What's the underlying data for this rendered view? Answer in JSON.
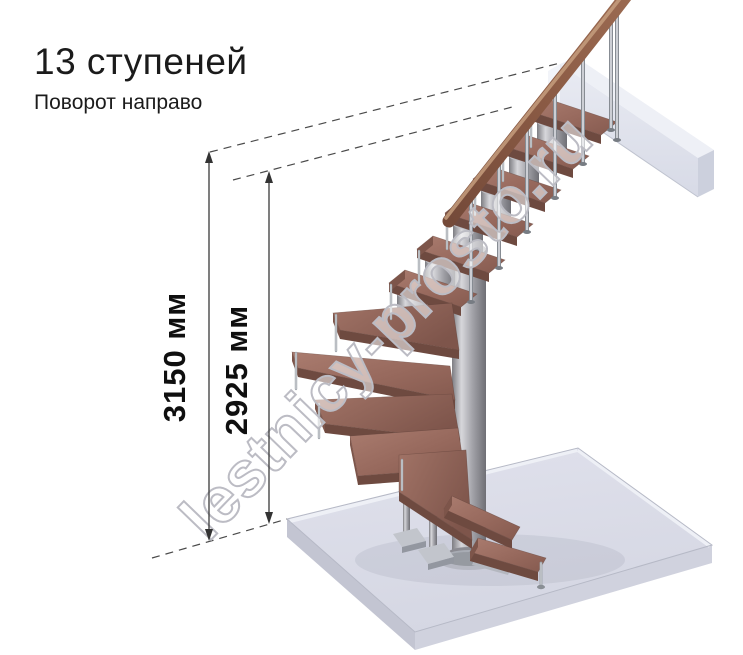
{
  "title": "13 ступеней",
  "subtitle": "Поворот направо",
  "staircase": {
    "steps_count": 13,
    "turn_direction": "направо",
    "type": "модульная лестница с поворотом 90°"
  },
  "dimensions": [
    {
      "id": "total-height",
      "label": "3150 мм",
      "value_mm": 3150
    },
    {
      "id": "height-to-top-step",
      "label": "2925 мм",
      "value_mm": 2925
    }
  ],
  "watermark": {
    "text": "lestnicy-prosto.ru"
  },
  "colors": {
    "wood_tread": "#9a6a5e",
    "wood_tread_edge": "#6e4a40",
    "handrail": "#8a5a44",
    "metal": "#b5b5b5",
    "floor_slab": "#dcdde8",
    "upper_beam": "#e7e9f1",
    "dimension_line": "#3a3a3a",
    "dashed_line": "#4a4a4a",
    "text": "#1b1b1b",
    "watermark_outline": "#bcbcc4"
  }
}
